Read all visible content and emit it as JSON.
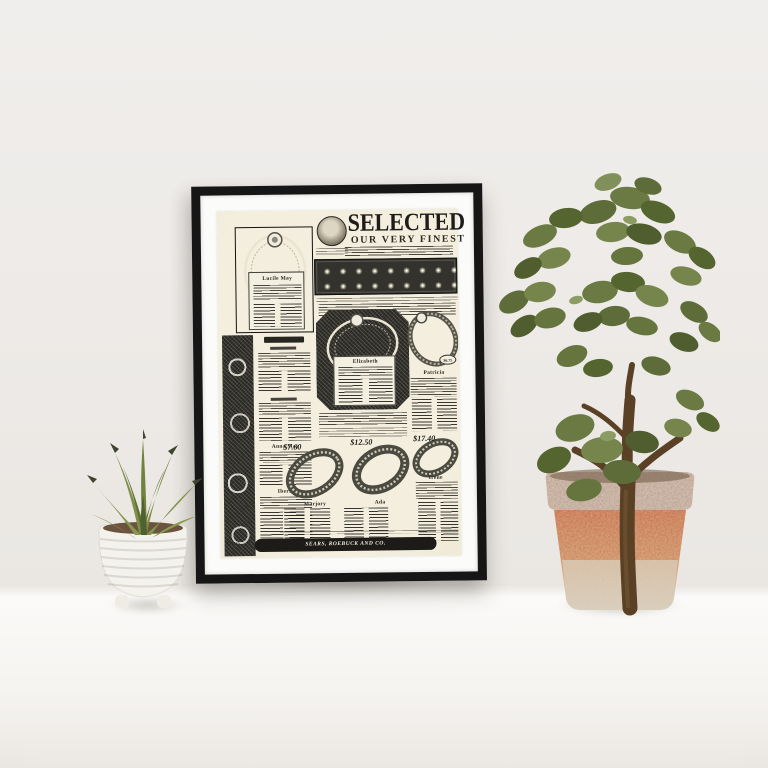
{
  "scene": {
    "objects": [
      "framed-vintage-print",
      "succulent-in-white-pot",
      "jade-plant-in-terracotta-pot"
    ],
    "colors": {
      "wall": "#edeae7",
      "surface": "#f6f4f1",
      "frame": "#161616",
      "mat": "#fbfbfa",
      "paper": "#f3eedd",
      "ink": "#23221d",
      "terracotta": "#c2683d",
      "weathered_white": "#cdc2b0",
      "white_pot": "#f4f2ed",
      "leaf_green": "#6b7a42",
      "leaf_dark": "#4c5a2e",
      "trunk_brown": "#5a4126"
    }
  },
  "poster": {
    "title": "SELECTED",
    "subtitle": "OUR VERY FINEST",
    "sections": {
      "top_left": {
        "name": "Lucile May"
      },
      "center": {
        "name": "Elizabeth"
      },
      "right": {
        "name": "Patricia",
        "price": "$6.75"
      },
      "left_column": {
        "names": [
          "Anna May",
          "Iberia"
        ]
      },
      "bottom_row": {
        "prices": [
          "$7.60",
          "$12.50",
          "$17.40"
        ],
        "names": [
          "Marjory",
          "Ada",
          "Irene"
        ]
      }
    },
    "footer": {
      "page_number": "370 ½",
      "banner": "SEARS, ROEBUCK AND CO."
    }
  }
}
